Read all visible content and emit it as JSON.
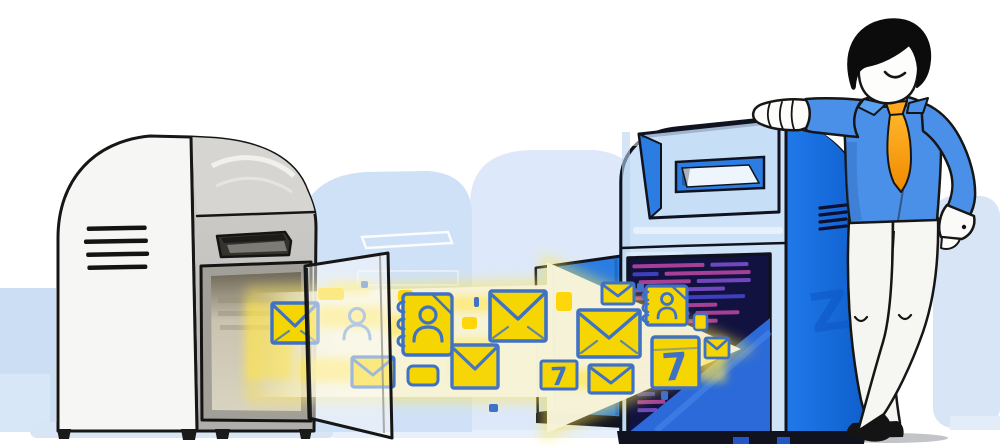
{
  "illustration": {
    "description": "Email migration illustration: envelopes, contact books and calendar items stream through a glowing yellow arrow from an old gray mailbox with an open door into a new blue mailbox; a smiling man in a blue shirt and orange tie leans on the new mailbox.",
    "calendar_day": "7",
    "watermark_letter": "Z",
    "arrow_items": [
      "envelope",
      "user-silhouette",
      "contact-book",
      "envelope",
      "envelope",
      "envelope",
      "envelope",
      "calendar-7",
      "envelope",
      "contact-book",
      "calendar-7",
      "envelope",
      "envelope"
    ],
    "colors": {
      "item_yellow": "#f6d602",
      "item_outline_blue": "#3f72c4",
      "arrow_cream": "#f7f3d8",
      "glow_yellow": "#ffe54d",
      "old_mailbox_front": "#f6f6f4",
      "old_mailbox_side": "#c9c8c5",
      "new_mailbox_front": "#cfe3f8",
      "new_mailbox_side": "#1d74e4",
      "new_mailbox_door": "#2b7de2",
      "data_panel_navy": "#111240",
      "data_line_magenta": "#b2449e",
      "background_silhouette_blue": "#d3e3f6",
      "shirt_blue": "#4a90e8",
      "tie_orange": "#ffa81e",
      "pants_white": "#f5f5f1",
      "hair_black": "#0c0c0c"
    }
  }
}
